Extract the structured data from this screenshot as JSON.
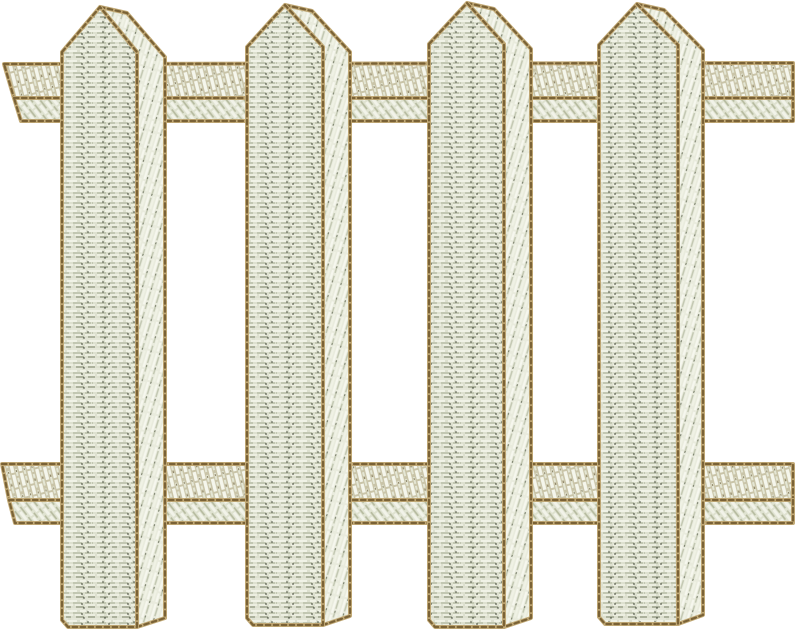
{
  "artwork": {
    "description": "Machine-embroidery design of a white picket fence: four vertical pickets with pointed (pentagon) tops and shaded right side faces, woven over two horizontal rails; satin-stitch fill in off-white/sage thread with tan running-stitch outlines on a white background.",
    "background_color": "#ffffff",
    "picket_count": 4,
    "rail_count": 2,
    "colors": {
      "thread_highlight": "#f4f5eb",
      "thread_base": "#dde0cf",
      "thread_shadow": "#8f957d",
      "thread_dark_speckle": "#454a3b",
      "rail_base": "#c9c4a8",
      "outline_tan": "#c2aa77",
      "outline_brown": "#7a6236"
    },
    "stitching": {
      "picket_face": "horizontal satin stitch with dark speckles",
      "picket_side": "steep diagonal satin stitch",
      "rail_upper_band": "vertical-diagonal rope-like satin stitch",
      "rail_lower_band": "narrow diagonal satin stitch"
    },
    "fence": {
      "rails": [
        {
          "id": "top-rail",
          "main_band": [
            [
              4,
              64
            ],
            [
              793,
              63
            ],
            [
              793,
              98
            ],
            [
              14,
              98
            ]
          ],
          "lower_band": [
            [
              14,
              98
            ],
            [
              793,
              98
            ],
            [
              793,
              121
            ],
            [
              21,
              121
            ]
          ]
        },
        {
          "id": "bottom-rail",
          "main_band": [
            [
              2,
              464
            ],
            [
              793,
              464
            ],
            [
              793,
              500
            ],
            [
              9,
              500
            ]
          ],
          "lower_band": [
            [
              9,
              500
            ],
            [
              793,
              500
            ],
            [
              793,
              523
            ],
            [
              15,
              523
            ]
          ]
        }
      ],
      "pickets": [
        {
          "id": "picket-1",
          "side": [
            [
              100,
              7
            ],
            [
              127,
              13
            ],
            [
              165,
              57
            ],
            [
              165,
              618
            ],
            [
              137,
              627
            ],
            [
              137,
              52
            ]
          ],
          "face": [
            [
              62,
              52
            ],
            [
              100,
              7
            ],
            [
              137,
              52
            ],
            [
              137,
              627
            ],
            [
              68,
              627
            ],
            [
              62,
              620
            ]
          ]
        },
        {
          "id": "picket-2",
          "side": [
            [
              285,
              5
            ],
            [
              312,
              11
            ],
            [
              350,
              52
            ],
            [
              350,
              616
            ],
            [
              323,
              625
            ],
            [
              323,
              47
            ]
          ],
          "face": [
            [
              247,
              47
            ],
            [
              285,
              5
            ],
            [
              323,
              47
            ],
            [
              323,
              625
            ],
            [
              253,
              625
            ],
            [
              247,
              618
            ]
          ]
        },
        {
          "id": "picket-3",
          "side": [
            [
              467,
              3
            ],
            [
              494,
              9
            ],
            [
              531,
              49
            ],
            [
              531,
              618
            ],
            [
              504,
              627
            ],
            [
              504,
              44
            ]
          ],
          "face": [
            [
              429,
              44
            ],
            [
              467,
              3
            ],
            [
              504,
              44
            ],
            [
              504,
              627
            ],
            [
              435,
              627
            ],
            [
              429,
              620
            ]
          ]
        },
        {
          "id": "picket-4",
          "side": [
            [
              637,
              4
            ],
            [
              664,
              10
            ],
            [
              703,
              50
            ],
            [
              703,
              615
            ],
            [
              678,
              624
            ],
            [
              678,
              45
            ]
          ],
          "face": [
            [
              599,
              45
            ],
            [
              637,
              4
            ],
            [
              678,
              45
            ],
            [
              678,
              624
            ],
            [
              605,
              624
            ],
            [
              599,
              617
            ]
          ]
        }
      ]
    }
  }
}
